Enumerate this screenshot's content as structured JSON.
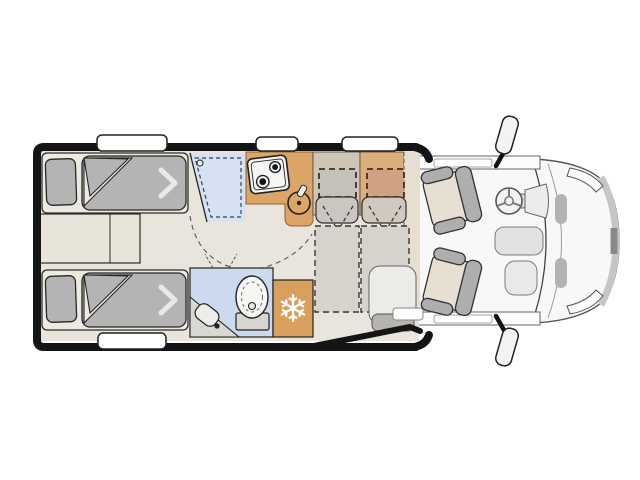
{
  "scene": {
    "kind": "motorhome-floorplan-top-view",
    "areas": [
      {
        "name": "rear-twin-single-beds"
      },
      {
        "name": "shower-cubicle"
      },
      {
        "name": "kitchen-block"
      },
      {
        "name": "washroom-with-toilet"
      },
      {
        "name": "freezer-unit"
      },
      {
        "name": "dinette-travel-bench"
      },
      {
        "name": "entry-door-open"
      },
      {
        "name": "driver-cab-with-swivel-seats"
      }
    ],
    "freezer_icon": {
      "glyph": "❄",
      "name": "snowflake-icon"
    },
    "window_count_top": 3,
    "window_count_bottom": 1,
    "mirror_count": 2,
    "bed_count": 2,
    "cab_seat_count": 2,
    "colors": {
      "wall": "#141414",
      "floor": "#eae5dc",
      "upholstery_gray": "#b4b4b4",
      "shower_blue": "#d6e1f3",
      "bathroom_blue": "#cbdaee",
      "kitchen_tan": "#daa566",
      "freezer_tan": "#d99f5d",
      "bench_tan": "#dcae79",
      "bench_beige": "#cfc5b4",
      "cushion_red_tan": "#cfa284",
      "cab_body": "#f8f8f7",
      "cab_seat_beige": "#e6dfd2",
      "bolster_gray": "#aeaeae",
      "window_white": "#ffffff"
    }
  }
}
